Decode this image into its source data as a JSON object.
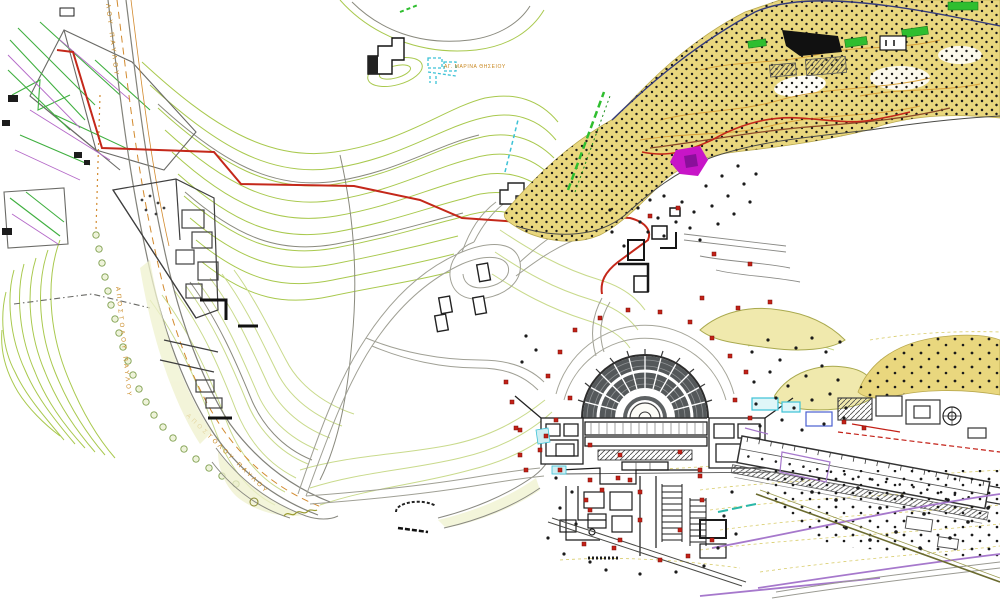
{
  "labels": {
    "road_top_partial": "ΛΟΥ ΠΑΥΛΟΥ",
    "road_mid": "ΑΠΟΣΤΟΛΟΥ ΠΑΥΛΟΥ",
    "road_bottom": "ΑΠΟΣΤΟΛΟΥ ΠΑΥΛΟΥ",
    "hill_area": "ΑΓ. ΜΑΡΙΝΑ ΘΗΣΕΙΟΥ"
  },
  "palette": {
    "contour_green": "#a9c94e",
    "contour_pale": "#c9da8c",
    "contour_gray": "#8a8a7e",
    "contour_yellow": "#d8cc6a",
    "road_gray": "#82827a",
    "orange": "#d28a2e",
    "label_orange": "#c8871f",
    "route_red": "#c4281a",
    "brown": "#8a4a28",
    "navy": "#333a7a",
    "cyan": "#3cc2d6",
    "bright_green": "#2fbe2f",
    "magenta": "#c715c7",
    "slope_yellow": "#e9d77e",
    "ruin_gray": "#3f3f3f",
    "theater_dark": "#54585a",
    "marker_red": "#c32017",
    "purple": "#a678cc",
    "olive": "#6b6b2f",
    "pale_fill": "#eff1cd"
  }
}
